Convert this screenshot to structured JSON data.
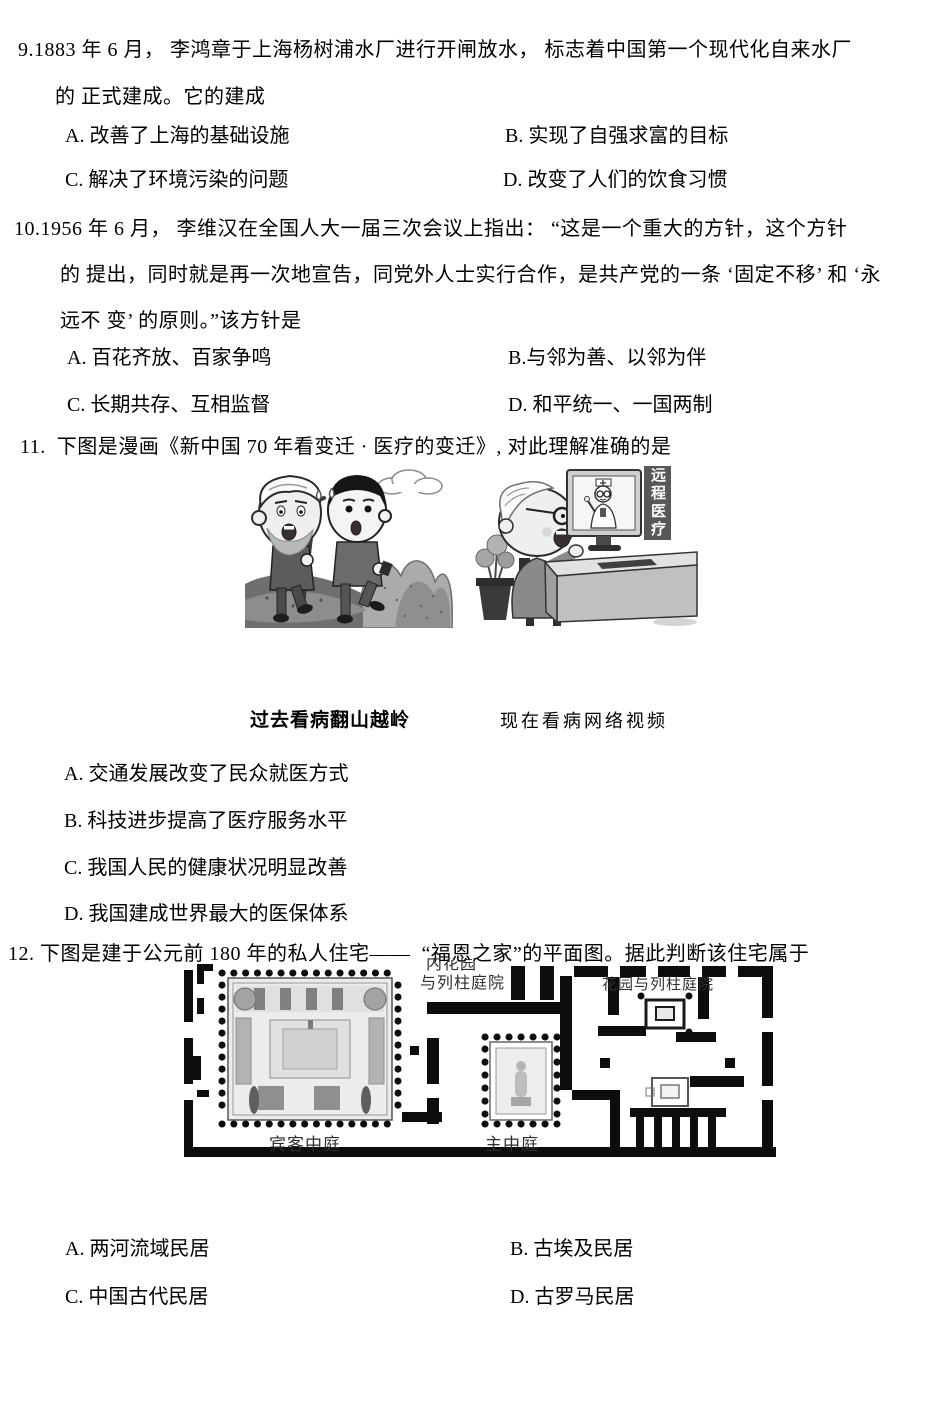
{
  "colors": {
    "background": "#ffffff",
    "text": "#000000",
    "banner_bg": "#585858",
    "banner_text": "#ffffff"
  },
  "q9": {
    "stem1": "9.1883 年 6 月， 李鸿章于上海杨树浦水厂进行开闸放水， 标志着中国第一个现代化自来水厂",
    "stem2": "的 正式建成。它的建成",
    "optA": "A. 改善了上海的基础设施",
    "optB": "B. 实现了自强求富的目标",
    "optC": "C. 解决了环境污染的问题",
    "optD": "D. 改变了人们的饮食习惯"
  },
  "q10": {
    "stem1": "10.1956 年 6 月， 李维汉在全国人大一届三次会议上指出： “这是一个重大的方针，这个方针",
    "stem2": "的 提出，同时就是再一次地宣告，同党外人士实行合作，是共产党的一条 ‘固定不移’ 和 ‘永",
    "stem3": "远不 变’ 的原则。”该方针是",
    "optA": "A. 百花齐放、百家争鸣",
    "optB": "B.与邻为善、以邻为伴",
    "optC": "C. 长期共存、互相监督",
    "optD": "D. 和平统一、一国两制"
  },
  "q11": {
    "stem": "11.  下图是漫画《新中国 70 年看变迁 · 医疗的变迁》, 对此理解准确的是",
    "cartoon": {
      "banner": "远程医疗",
      "caption_left": "过去看病翻山越岭",
      "caption_right": "现在看病网络视频"
    },
    "optA": "A. 交通发展改变了民众就医方式",
    "optB": "B. 科技进步提高了医疗服务水平",
    "optC": "C. 我国人民的健康状况明显改善",
    "optD": "D. 我国建成世界最大的医保体系"
  },
  "q12": {
    "stem": "12. 下图是建于公元前 180 年的私人住宅——  “福恩之家”的平面图。据此判断该住宅属于",
    "plan": {
      "label_garden_partial": "内花园",
      "label_peristyle_left": "与列柱庭院",
      "label_peristyle_right": "花园与列柱庭院",
      "label_guest_atrium": "宾客中庭",
      "label_main_atrium": "主中庭"
    },
    "optA": "A. 两河流域民居",
    "optB": "B. 古埃及民居",
    "optC": "C. 中国古代民居",
    "optD": "D. 古罗马民居"
  }
}
